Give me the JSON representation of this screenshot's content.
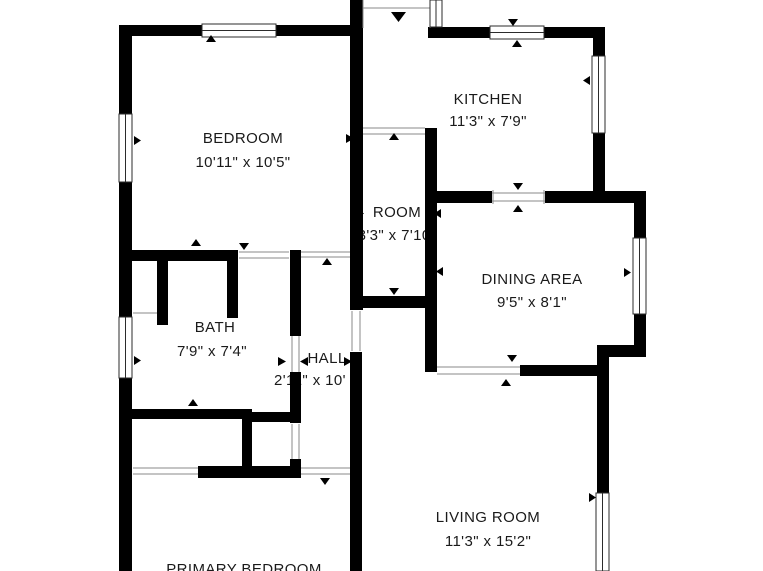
{
  "plan": {
    "background": "#ffffff",
    "wall_color": "#000000",
    "opening_line_color": "#8a8a8a",
    "text_color": "#1a1a1a"
  },
  "rooms": {
    "bedroom": {
      "name": "BEDROOM",
      "dims": "10'11\" x 10'5\""
    },
    "kitchen": {
      "name": "KITCHEN",
      "dims": "11'3\" x 7'9\""
    },
    "room": {
      "name": "ROOM",
      "dims": "3'3\" x 7'10\""
    },
    "dining": {
      "name": "DINING AREA",
      "dims": "9'5\" x 8'1\""
    },
    "bath": {
      "name": "BATH",
      "dims": "7'9\" x 7'4\""
    },
    "hall": {
      "name": "HALL",
      "dims": "2'11\" x 10'"
    },
    "living": {
      "name": "LIVING ROOM",
      "dims": "11'3\" x 15'2\""
    },
    "primary": {
      "name": "PRIMARY BEDROOM"
    }
  }
}
